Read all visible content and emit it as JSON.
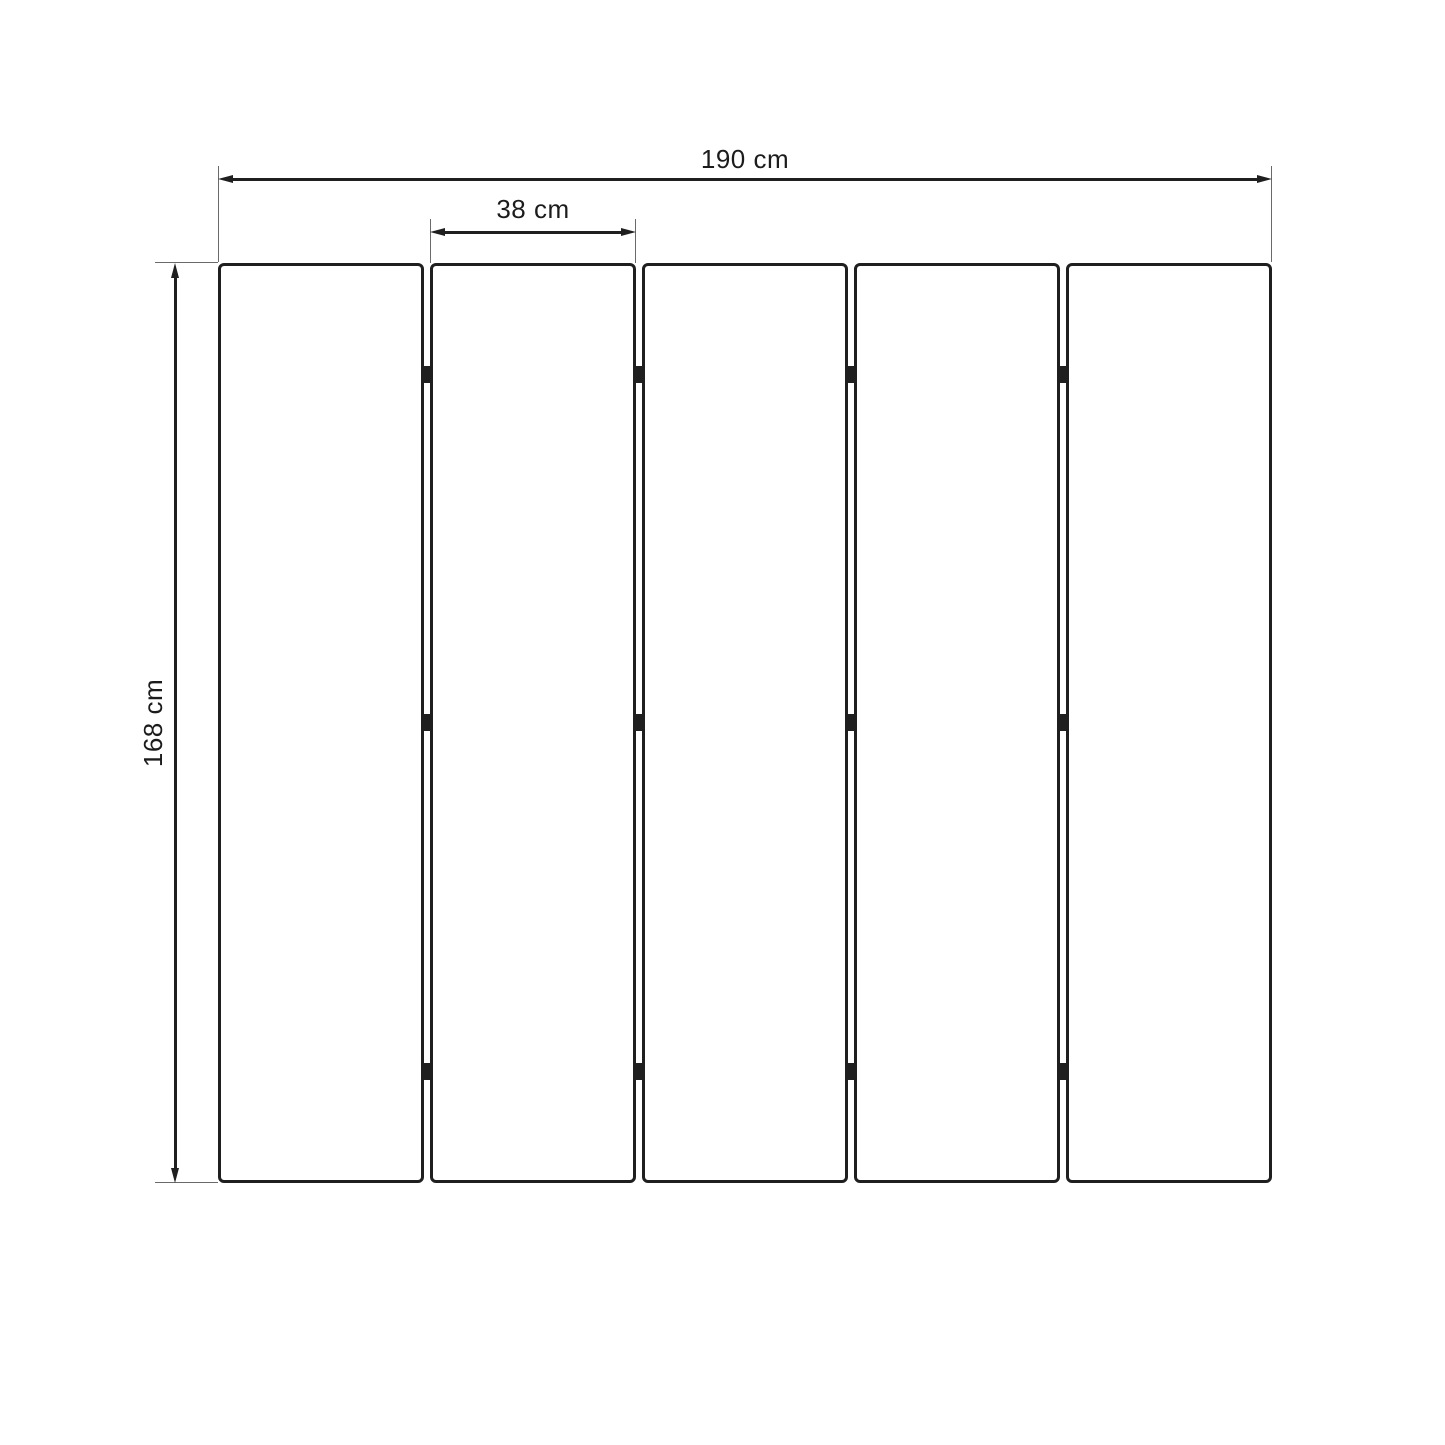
{
  "labels": {
    "total_width": "190 cm",
    "panel_width": "38 cm",
    "height": "168 cm"
  },
  "panels": {
    "count": 5,
    "gap_count": 4,
    "hinge_rows_per_gap": 3
  },
  "colors": {
    "background": "#ffffff",
    "line": "#1f1f1f",
    "extension_line": "#6a6a6a",
    "text": "#1c1c1c",
    "panel_fill": "#ffffff"
  }
}
